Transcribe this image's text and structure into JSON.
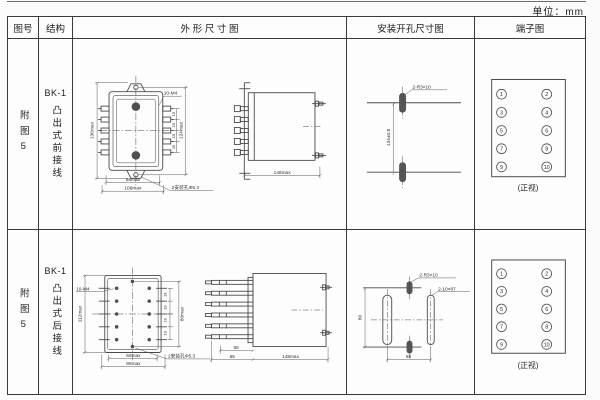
{
  "unit_label": "单位：mm",
  "header": {
    "fig_no": "图号",
    "structure": "结构",
    "outline": "外 形 尺 寸 图",
    "mounting": "安装开孔尺寸图",
    "terminal": "端子图"
  },
  "rows": [
    {
      "fig_no": "附图5",
      "model": "BK-1",
      "structure": "凸出式前接线",
      "outline_front": {
        "height_outer": "136max",
        "height_inner": "124max",
        "pitch": "19",
        "thread": "10-M4",
        "width_inner": "98max",
        "width_outer": "106max",
        "hole_note": "2安装孔Φ5.3"
      },
      "outline_side": {
        "length": "148max"
      },
      "mounting": {
        "slot_label": "2-R3×10",
        "vertical_dim": "134±0.8"
      },
      "terminal": {
        "left": [
          "1",
          "3",
          "5",
          "7",
          "9"
        ],
        "right": [
          "2",
          "4",
          "6",
          "8",
          "10"
        ],
        "caption": "(正视)"
      }
    },
    {
      "fig_no": "附图5",
      "model": "BK-1",
      "structure": "凸出式后接线",
      "outline_front": {
        "thread": "10-M4",
        "height_outer": "112max",
        "height_inner": "80max",
        "pitch": "19",
        "width_inner": "68max",
        "width_outer": "88max",
        "hole_note": "2安装孔Φ5.3"
      },
      "outline_side": {
        "stud_dim": "55",
        "offset_dim": "65",
        "length": "148max"
      },
      "mounting": {
        "small_slot_label": "2-R3×10",
        "large_slot_label": "2-10×87",
        "vertical_dim": "80",
        "horizontal_dim": "68"
      },
      "terminal": {
        "left": [
          "1",
          "3",
          "5",
          "7",
          "9"
        ],
        "right": [
          "2",
          "4",
          "6",
          "8",
          "10"
        ],
        "caption": "(正视)"
      }
    }
  ]
}
